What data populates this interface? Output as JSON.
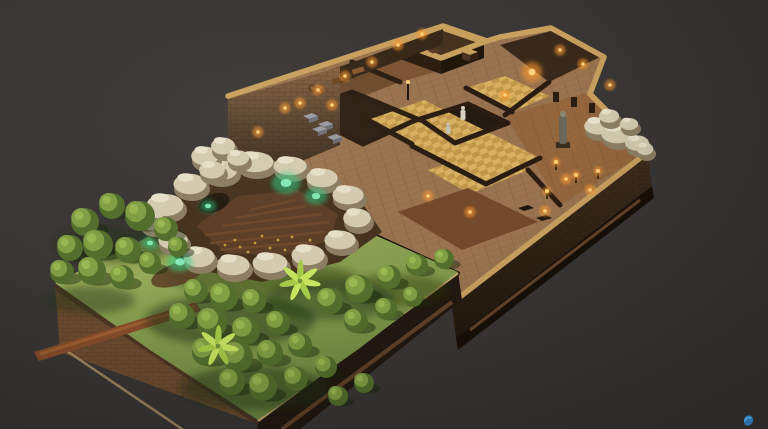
{
  "meta": {
    "title": "Isometric voxel diorama — stone dungeon complex with walled garden, rock crater field and torch-lit rooms on a dark backdrop"
  },
  "palette": {
    "bg": "#3a3736",
    "grassA": "#b7c46c",
    "grassB": "#8ba052",
    "grassC": "#6f8a42",
    "treeDark": "#546f2d",
    "treeLight": "#83a045",
    "treeHi": "#9dbb55",
    "palmLeaf": "#c8e55f",
    "palmLeafDark": "#a6cb48",
    "rockLight": "#d5ccb1",
    "rockHi": "#e9e2cb",
    "rockShade": "#8c7f65",
    "hill": "#46331f",
    "dirt": "#5d3f28",
    "dirtRow": "#70492c",
    "speckle": "#c59c42",
    "glowGreen": "#2bd287",
    "glowGreenHi": "#8df3c0",
    "floorWood": "#9a7450",
    "floorPlank": "#95673f",
    "goldA": "#d9b160",
    "goldB": "#c2984a",
    "roomDark": "#46321f",
    "roomDarker": "#241911",
    "roomDarkest": "#2c1f13",
    "corridor": "#7c5533",
    "corridor2": "#6e4c2e",
    "forgeRoom": "#39291a",
    "terrace": "#73492b",
    "wallCap": "#c9a15f",
    "wallFace": "#362717",
    "wallDark": "#2a1c10",
    "sideLit": "#6f4e31",
    "sideDark": "#221911",
    "rimTan": "#c9a874",
    "baseCourse": "#6b4a2e",
    "path": "#8a4f2c",
    "pathHi": "#a66535",
    "torch": "#ff9a2e",
    "torchCore": "#ffd27a",
    "bedTop": "#9a9aa4",
    "bedSide": "#6e6e78",
    "statue": "#d9d3c3",
    "wmBlue": "#4aa3d8",
    "wmDeep": "#2b6ea8"
  },
  "scene": {
    "backdrop": {
      "label": "dark warm-gray studio backdrop with vignette"
    },
    "building": {
      "label": "torch-lit multi-room stone dungeon on raised platform"
    },
    "crater": {
      "label": "rock ring crater with tilled dirt field and green crystal glows"
    },
    "garden": {
      "label": "walled garden terrace with round trees, palms and a dirt path"
    },
    "trees": [
      [
        85,
        222,
        14
      ],
      [
        112,
        206,
        13
      ],
      [
        140,
        216,
        15
      ],
      [
        166,
        229,
        12
      ],
      [
        70,
        248,
        13
      ],
      [
        98,
        245,
        15
      ],
      [
        128,
        250,
        13
      ],
      [
        62,
        272,
        12
      ],
      [
        92,
        271,
        14
      ],
      [
        122,
        277,
        12
      ],
      [
        150,
        263,
        11
      ],
      [
        178,
        247,
        10
      ],
      [
        196,
        291,
        12
      ],
      [
        224,
        297,
        14
      ],
      [
        254,
        301,
        12
      ],
      [
        182,
        316,
        13
      ],
      [
        212,
        323,
        15
      ],
      [
        246,
        331,
        14
      ],
      [
        278,
        323,
        12
      ],
      [
        206,
        352,
        14
      ],
      [
        238,
        357,
        15
      ],
      [
        270,
        353,
        13
      ],
      [
        300,
        345,
        12
      ],
      [
        232,
        382,
        13
      ],
      [
        263,
        387,
        14
      ],
      [
        296,
        379,
        12
      ],
      [
        326,
        367,
        11
      ],
      [
        330,
        301,
        13
      ],
      [
        359,
        289,
        14
      ],
      [
        389,
        277,
        12
      ],
      [
        417,
        265,
        11
      ],
      [
        444,
        259,
        10
      ],
      [
        356,
        321,
        12
      ],
      [
        386,
        309,
        11
      ],
      [
        413,
        297,
        10
      ],
      [
        338,
        396,
        10
      ],
      [
        364,
        383,
        10
      ]
    ],
    "palms": [
      [
        300,
        281
      ],
      [
        218,
        346
      ]
    ],
    "torches": [
      [
        398,
        45
      ],
      [
        422,
        34
      ],
      [
        372,
        62
      ],
      [
        345,
        76
      ],
      [
        318,
        90
      ],
      [
        300,
        103
      ],
      [
        332,
        105
      ],
      [
        560,
        50
      ],
      [
        583,
        64
      ],
      [
        505,
        95
      ],
      [
        610,
        85
      ],
      [
        428,
        196
      ],
      [
        470,
        212
      ],
      [
        285,
        108
      ],
      [
        258,
        132
      ],
      [
        545,
        211
      ],
      [
        566,
        179
      ],
      [
        590,
        190
      ]
    ],
    "forge": [
      532,
      72
    ],
    "braziers": [
      [
        556,
        170
      ],
      [
        576,
        183
      ],
      [
        547,
        199
      ],
      [
        598,
        179
      ]
    ],
    "beds": [
      [
        303,
        116
      ],
      [
        318,
        124
      ],
      [
        312,
        129
      ],
      [
        327,
        137
      ]
    ],
    "ringRocks": [
      [
        165,
        207,
        20,
        13
      ],
      [
        190,
        186,
        18,
        12
      ],
      [
        220,
        172,
        19,
        12
      ],
      [
        255,
        164,
        20,
        12
      ],
      [
        290,
        168,
        18,
        11
      ],
      [
        322,
        180,
        17,
        11
      ],
      [
        348,
        197,
        17,
        11
      ],
      [
        357,
        220,
        15,
        11
      ],
      [
        340,
        242,
        17,
        11
      ],
      [
        308,
        257,
        18,
        12
      ],
      [
        270,
        265,
        19,
        12
      ],
      [
        233,
        267,
        18,
        12
      ],
      [
        199,
        259,
        17,
        12
      ],
      [
        173,
        242,
        16,
        11
      ],
      [
        153,
        224,
        14,
        10
      ],
      [
        205,
        158,
        15,
        11
      ],
      [
        223,
        148,
        13,
        10
      ],
      [
        212,
        172,
        14,
        10
      ],
      [
        238,
        160,
        12,
        9
      ]
    ],
    "outcropRocks": [
      [
        598,
        128,
        15,
        10
      ],
      [
        617,
        136,
        17,
        11
      ],
      [
        637,
        145,
        13,
        9
      ],
      [
        609,
        118,
        11,
        8
      ],
      [
        629,
        126,
        10,
        7
      ],
      [
        645,
        151,
        9,
        7
      ]
    ],
    "glows": [
      [
        286,
        183,
        9
      ],
      [
        316,
        196,
        7
      ],
      [
        180,
        262,
        8
      ],
      [
        150,
        243,
        5
      ],
      [
        208,
        206,
        5
      ]
    ],
    "speckles": [
      [
        255,
        243
      ],
      [
        270,
        248
      ],
      [
        285,
        250
      ],
      [
        300,
        246
      ],
      [
        240,
        247
      ],
      [
        262,
        236
      ],
      [
        278,
        240
      ],
      [
        292,
        237
      ],
      [
        248,
        252
      ],
      [
        268,
        255
      ],
      [
        310,
        240
      ],
      [
        235,
        240
      ],
      [
        302,
        252
      ],
      [
        225,
        245
      ]
    ]
  }
}
